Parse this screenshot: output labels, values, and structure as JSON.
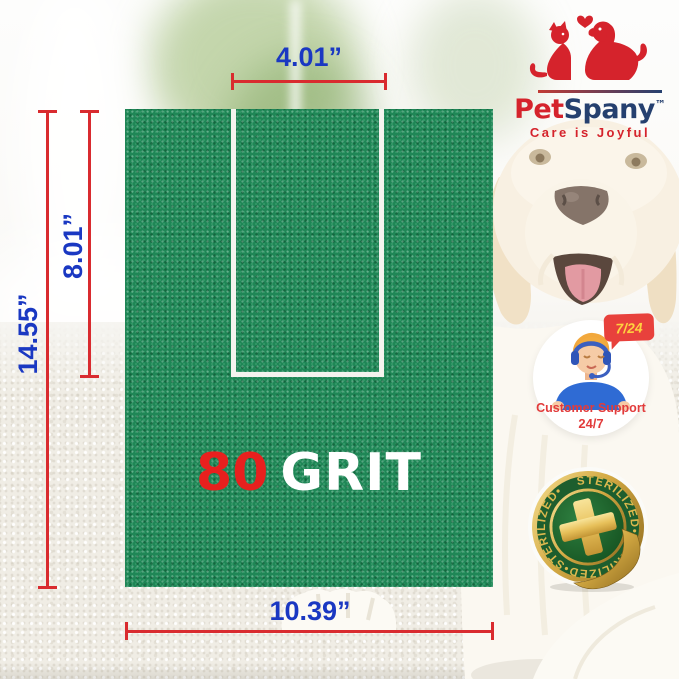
{
  "brand": {
    "name_primary": "Pet",
    "name_secondary": "Spany",
    "trademark": "™",
    "tagline": "Care is Joyful"
  },
  "dimensions": {
    "top_width": "4.01”",
    "notch_depth": "8.01”",
    "panel_height": "14.55”",
    "panel_width": "10.39”"
  },
  "grit": {
    "number": "80",
    "word": "GRIT"
  },
  "support_badge": {
    "bubble": "7/24",
    "line1": "Customer Support",
    "line2": "24/7"
  },
  "sterilized_badge": {
    "ring_text": "STERILIZED•STERILIZED•STERILIZED•"
  },
  "colors": {
    "panel_green": "#1f8656",
    "dimension_red": "#d92b2f",
    "dimension_blue": "#1a38c2",
    "grit_red": "#e8201e",
    "brand_red": "#d5232c",
    "brand_navy": "#25406f",
    "badge_gold": "#dcb84e",
    "badge_green": "#1d5e2e",
    "support_red": "#e23b3b",
    "bubble_red": "#e8413c",
    "bubble_yellow": "#ffd23f"
  }
}
